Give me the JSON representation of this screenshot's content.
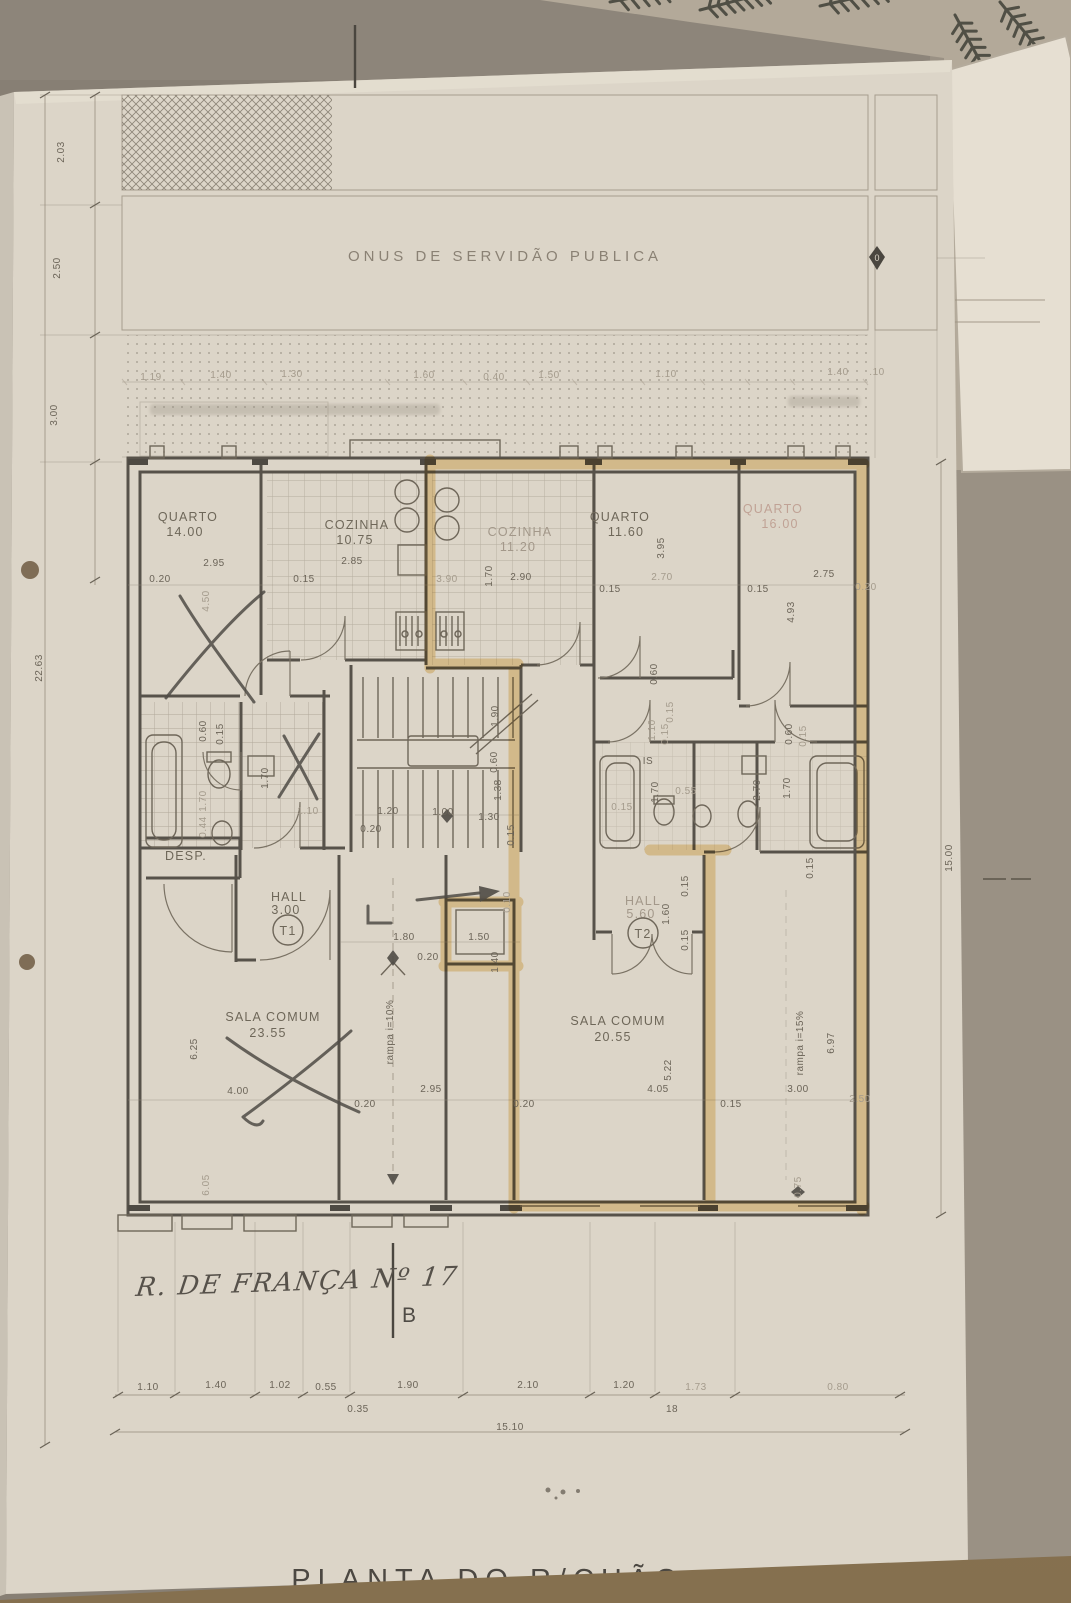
{
  "document": {
    "title_partial": "PLANTA DO R/CHÃO",
    "street_note": "R. DE FRANÇA Nº 17",
    "section_letter": "B"
  },
  "easement": {
    "label": "ONUS DE SERVIDÃO PUBLICA",
    "marker": "0"
  },
  "units": {
    "t1": "T1",
    "t2": "T2"
  },
  "rooms": [
    {
      "name": "QUARTO",
      "area": "14.00"
    },
    {
      "name": "COZINHA",
      "area": "10.75"
    },
    {
      "name": "COZINHA",
      "area": "11.20"
    },
    {
      "name": "QUARTO",
      "area": "11.60"
    },
    {
      "name": "QUARTO",
      "area": "16.00"
    },
    {
      "name": "HALL",
      "area": "3.00"
    },
    {
      "name": "HALL",
      "area": "5.60"
    },
    {
      "name": "SALA COMUM",
      "area": "23.55"
    },
    {
      "name": "SALA COMUM",
      "area": "20.55"
    },
    {
      "name": "DESP.",
      "area": ""
    }
  ],
  "ramps": {
    "left": "rampa i=10%",
    "right": "rampa i=15%"
  },
  "colors": {
    "paper": "#dcd5c8",
    "ink": "#57524a",
    "highlighter": "#e9bd62",
    "pencil": "#4f4b45",
    "table": "#8b7252"
  },
  "dim_labels": [
    {
      "t": "1.19",
      "x": 151,
      "y": 380,
      "f": true
    },
    {
      "t": "1.40",
      "x": 221,
      "y": 378,
      "f": true
    },
    {
      "t": "1.30",
      "x": 292,
      "y": 377,
      "f": true
    },
    {
      "t": "1.60",
      "x": 424,
      "y": 378,
      "f": true
    },
    {
      "t": "0.40",
      "x": 494,
      "y": 380,
      "f": true
    },
    {
      "t": "1.50",
      "x": 549,
      "y": 378,
      "f": true
    },
    {
      "t": "1.10",
      "x": 666,
      "y": 377,
      "f": true
    },
    {
      "t": "1.40",
      "x": 838,
      "y": 375,
      "f": true
    },
    {
      "t": ".10",
      "x": 877,
      "y": 375,
      "f": true
    },
    {
      "t": "2.03",
      "x": 64,
      "y": 152,
      "r": -90
    },
    {
      "t": "2.50",
      "x": 60,
      "y": 268,
      "r": -90
    },
    {
      "t": "3.00",
      "x": 57,
      "y": 415,
      "r": -90
    },
    {
      "t": "22.63",
      "x": 42,
      "y": 668,
      "r": -90
    },
    {
      "t": "15.00",
      "x": 952,
      "y": 858,
      "r": -90
    },
    {
      "t": "0.20",
      "x": 160,
      "y": 582
    },
    {
      "t": "2.95",
      "x": 214,
      "y": 566
    },
    {
      "t": "4.50",
      "x": 209,
      "y": 601,
      "r": -90,
      "f": true
    },
    {
      "t": "0.15",
      "x": 304,
      "y": 582
    },
    {
      "t": "2.85",
      "x": 352,
      "y": 564
    },
    {
      "t": "3.90",
      "x": 447,
      "y": 582,
      "f": true
    },
    {
      "t": "1.70",
      "x": 492,
      "y": 576,
      "r": -90
    },
    {
      "t": "2.90",
      "x": 521,
      "y": 580
    },
    {
      "t": "0.15",
      "x": 610,
      "y": 592
    },
    {
      "t": "3.95",
      "x": 664,
      "y": 548,
      "r": -90
    },
    {
      "t": "2.70",
      "x": 662,
      "y": 580,
      "f": true
    },
    {
      "t": "0.15",
      "x": 758,
      "y": 592
    },
    {
      "t": "2.75",
      "x": 824,
      "y": 577
    },
    {
      "t": "0.20",
      "x": 866,
      "y": 590,
      "f": true
    },
    {
      "t": "4.93",
      "x": 794,
      "y": 612,
      "r": -90
    },
    {
      "t": "0.60",
      "x": 657,
      "y": 674,
      "r": -90
    },
    {
      "t": "0.15",
      "x": 673,
      "y": 712,
      "r": -90,
      "f": true
    },
    {
      "t": "1.90",
      "x": 498,
      "y": 716,
      "r": -90
    },
    {
      "t": "0.60",
      "x": 497,
      "y": 762,
      "r": -90
    },
    {
      "t": "1.38",
      "x": 501,
      "y": 790,
      "r": -90
    },
    {
      "t": "1.20",
      "x": 388,
      "y": 814
    },
    {
      "t": "1.00",
      "x": 443,
      "y": 815
    },
    {
      "t": "1.30",
      "x": 489,
      "y": 820
    },
    {
      "t": "0.20",
      "x": 371,
      "y": 832
    },
    {
      "t": "0.15",
      "x": 514,
      "y": 835,
      "r": -90
    },
    {
      "t": "0.60",
      "x": 206,
      "y": 731,
      "r": -90
    },
    {
      "t": "0.15",
      "x": 223,
      "y": 734,
      "r": -90
    },
    {
      "t": "1.70",
      "x": 268,
      "y": 778,
      "r": -90
    },
    {
      "t": "1.70",
      "x": 206,
      "y": 801,
      "r": -90,
      "f": true
    },
    {
      "t": "0.44",
      "x": 206,
      "y": 827,
      "r": -90,
      "f": true
    },
    {
      "t": "1.10",
      "x": 308,
      "y": 814,
      "f": true
    },
    {
      "t": "IS",
      "x": 648,
      "y": 764,
      "s": 11
    },
    {
      "t": "1.10",
      "x": 655,
      "y": 730,
      "r": -90,
      "f": true
    },
    {
      "t": "0.15",
      "x": 668,
      "y": 734,
      "r": -90,
      "f": true
    },
    {
      "t": "1.70",
      "x": 658,
      "y": 792,
      "r": -90
    },
    {
      "t": "0.55",
      "x": 686,
      "y": 794,
      "f": true
    },
    {
      "t": "0.15",
      "x": 622,
      "y": 810,
      "f": true
    },
    {
      "t": "2.70",
      "x": 760,
      "y": 790,
      "r": -90
    },
    {
      "t": "1.70",
      "x": 790,
      "y": 788,
      "r": -90
    },
    {
      "t": "0.60",
      "x": 792,
      "y": 734,
      "r": -90
    },
    {
      "t": "0.15",
      "x": 806,
      "y": 736,
      "r": -90,
      "f": true
    },
    {
      "t": "1.80",
      "x": 404,
      "y": 940
    },
    {
      "t": "0.20",
      "x": 428,
      "y": 960
    },
    {
      "t": "1.50",
      "x": 479,
      "y": 940
    },
    {
      "t": "1.40",
      "x": 498,
      "y": 962,
      "r": -90
    },
    {
      "t": "1.60",
      "x": 669,
      "y": 914,
      "r": -90
    },
    {
      "t": "0.15",
      "x": 688,
      "y": 886,
      "r": -90
    },
    {
      "t": "0.15",
      "x": 688,
      "y": 940,
      "r": -90
    },
    {
      "t": "0.10",
      "x": 510,
      "y": 902,
      "r": -90,
      "f": true
    },
    {
      "t": "6.25",
      "x": 197,
      "y": 1049,
      "r": -90
    },
    {
      "t": "4.00",
      "x": 238,
      "y": 1094
    },
    {
      "t": "0.20",
      "x": 365,
      "y": 1107
    },
    {
      "t": "2.95",
      "x": 431,
      "y": 1092
    },
    {
      "t": "0.20",
      "x": 524,
      "y": 1107
    },
    {
      "t": "4.05",
      "x": 658,
      "y": 1092
    },
    {
      "t": "5.22",
      "x": 671,
      "y": 1070,
      "r": -90
    },
    {
      "t": "0.15",
      "x": 731,
      "y": 1107
    },
    {
      "t": "3.00",
      "x": 798,
      "y": 1092
    },
    {
      "t": "2.50",
      "x": 860,
      "y": 1102,
      "f": true
    },
    {
      "t": "6.05",
      "x": 209,
      "y": 1185,
      "r": -90,
      "f": true
    },
    {
      "t": "0.75",
      "x": 801,
      "y": 1187,
      "r": -90,
      "f": true
    },
    {
      "t": "6.97",
      "x": 834,
      "y": 1043,
      "r": -90
    },
    {
      "t": "0.15",
      "x": 813,
      "y": 868,
      "r": -90
    },
    {
      "t": "1.10",
      "x": 148,
      "y": 1390
    },
    {
      "t": "1.40",
      "x": 216,
      "y": 1388
    },
    {
      "t": "1.02",
      "x": 280,
      "y": 1388
    },
    {
      "t": "0.55",
      "x": 326,
      "y": 1390
    },
    {
      "t": "1.90",
      "x": 408,
      "y": 1388
    },
    {
      "t": "2.10",
      "x": 528,
      "y": 1388
    },
    {
      "t": "1.20",
      "x": 624,
      "y": 1388
    },
    {
      "t": "1.73",
      "x": 696,
      "y": 1390,
      "f": true
    },
    {
      "t": "0.80",
      "x": 838,
      "y": 1390,
      "f": true
    },
    {
      "t": "0.35",
      "x": 358,
      "y": 1412
    },
    {
      "t": "18",
      "x": 672,
      "y": 1412
    },
    {
      "t": "15.10",
      "x": 510,
      "y": 1430
    }
  ]
}
